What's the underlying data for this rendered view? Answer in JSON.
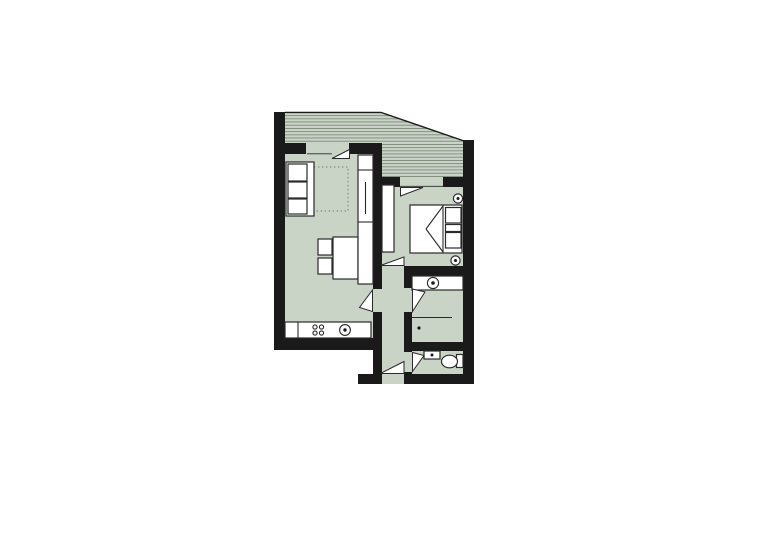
{
  "plan": {
    "type": "apartment-floor-plan",
    "rooms": [
      {
        "name": "balcony",
        "features": [
          "hatched-floor",
          "railing",
          "sloped-outer-edge"
        ]
      },
      {
        "name": "living-room",
        "furniture": [
          "sofa",
          "rug",
          "dining-table",
          "chair",
          "chair",
          "closet",
          "kitchen-counter",
          "hob-4-burners",
          "kitchen-sink"
        ]
      },
      {
        "name": "bedroom",
        "furniture": [
          "wardrobe",
          "double-bed",
          "pillow",
          "pillow",
          "wall-lamp",
          "wall-lamp"
        ]
      },
      {
        "name": "corridor",
        "furniture": []
      },
      {
        "name": "bathroom",
        "furniture": [
          "vanity-with-sink",
          "shower-partition",
          "floor-drain"
        ]
      },
      {
        "name": "wc",
        "furniture": [
          "hand-basin",
          "toilet"
        ]
      }
    ],
    "doors": [
      "living-room-balcony-door",
      "bedroom-balcony-door",
      "bedroom-door",
      "living-room-door",
      "bathroom-door",
      "wc-door",
      "entrance-door"
    ]
  },
  "colors": {
    "background": "#ffffff",
    "wall": "#1a1a1a",
    "floor": "#c9d3c6",
    "hatch": "#6e7a6e",
    "furniture": "#ffffff",
    "outline": "#2a2a2a",
    "rug_border": "#7a827a"
  }
}
